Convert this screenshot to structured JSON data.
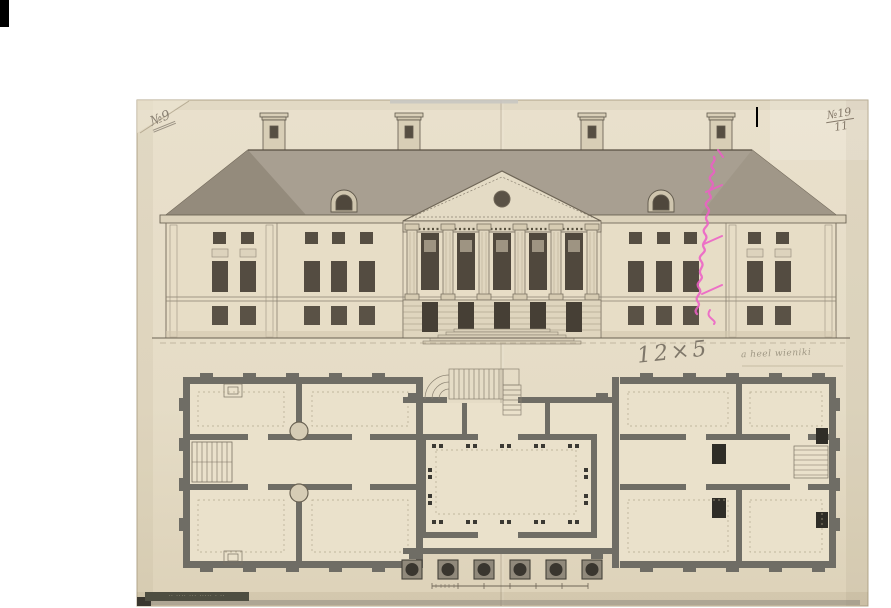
{
  "document": {
    "kind": "scanned architectural drawing",
    "subject": "Neoclassical palace: main facade elevation above ground-floor plan"
  },
  "annotations": {
    "corner_number_left": "№9",
    "corner_number_right_top": "№19",
    "corner_number_right_bottom": "11",
    "dimension_note": "12×5",
    "pencil_note": "a heel wieniki",
    "stamp_text": "·· ···· ··· ····· · ··"
  },
  "colors": {
    "paper": "#e6ddc7",
    "ink": "#5f584b",
    "roof_wash": "#a89f91",
    "window_fill": "#544c41",
    "plan_walls": "#6f6d65",
    "pink_ink": "#ee5ec6",
    "pencil": "#8a8173"
  }
}
